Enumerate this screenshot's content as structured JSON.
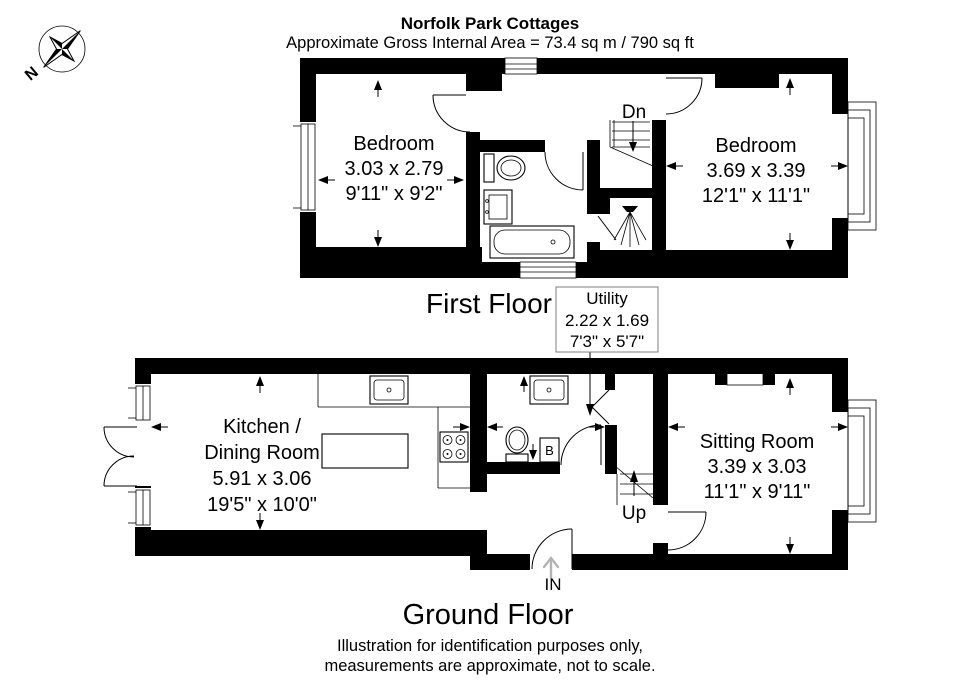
{
  "header": {
    "title": "Norfolk Park Cottages",
    "subtitle": "Approximate Gross Internal Area = 73.4 sq m / 790 sq ft"
  },
  "compass": {
    "north": "N"
  },
  "floors": {
    "first": {
      "label": "First Floor"
    },
    "ground": {
      "label": "Ground Floor"
    }
  },
  "rooms": {
    "bedroom1": {
      "name": "Bedroom",
      "metric": "3.03 x 2.79",
      "imperial": "9'11\" x 9'2\""
    },
    "bedroom2": {
      "name": "Bedroom",
      "metric": "3.69 x 3.39",
      "imperial": "12'1\" x 11'1\""
    },
    "kitchen": {
      "name1": "Kitchen /",
      "name2": "Dining Room",
      "metric": "5.91 x 3.06",
      "imperial": "19'5\" x 10'0\""
    },
    "sitting": {
      "name": "Sitting Room",
      "metric": "3.39 x 3.03",
      "imperial": "11'1\" x 9'11\""
    },
    "utility": {
      "name": "Utility",
      "metric": "2.22 x 1.69",
      "imperial": "7'3\" x 5'7\""
    }
  },
  "marks": {
    "down": "Dn",
    "up": "Up",
    "entrance": "IN",
    "boiler": "B"
  },
  "footer": {
    "line1": "Illustration for identification purposes only,",
    "line2": "measurements are approximate, not to scale."
  },
  "colors": {
    "wall": "#000000",
    "leader_box_border": "#7f7f7f",
    "entrance_arrow": "#b3b3b3"
  }
}
